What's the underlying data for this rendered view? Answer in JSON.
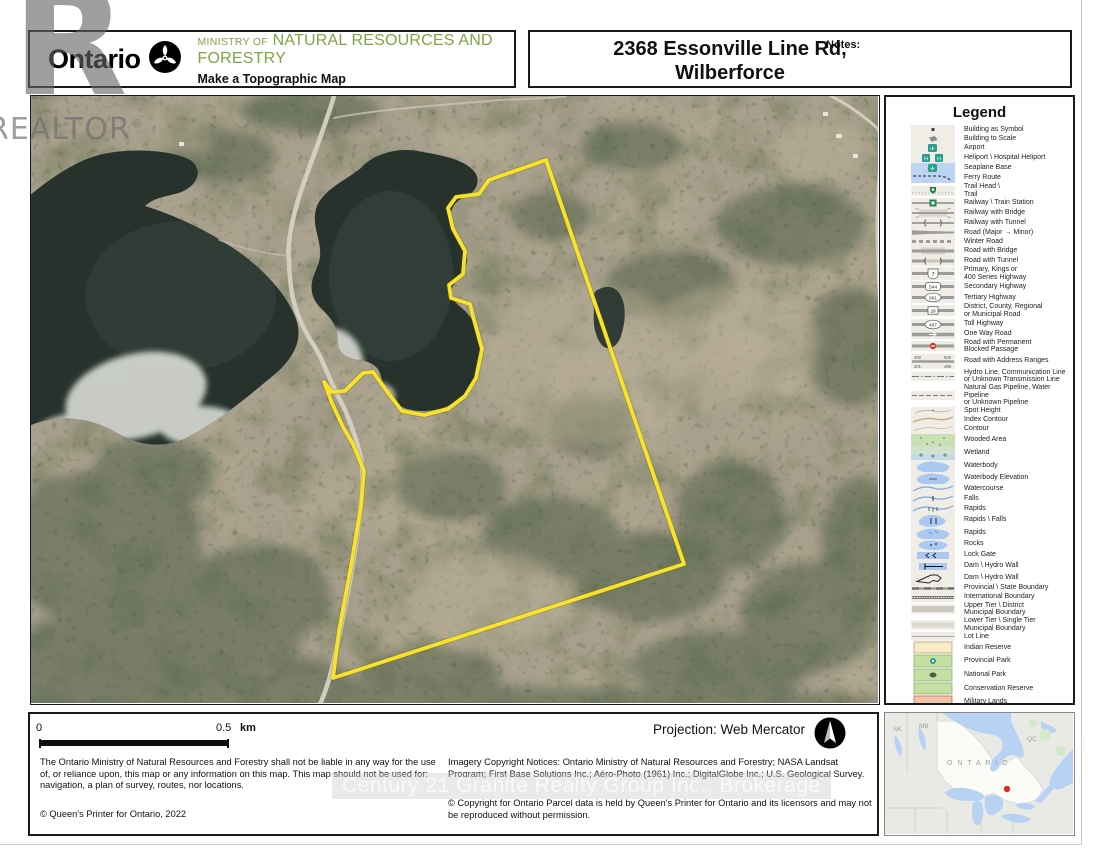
{
  "header": {
    "logo_text": "Ontario",
    "ministry_line_small": "MINISTRY OF",
    "ministry_line_big": "NATURAL RESOURCES AND FORESTRY",
    "app_title": "Make a Topographic Map",
    "map_title_line1": "2368 Essonville Line Rd,",
    "map_title_line2": "Wilberforce",
    "notes_label": "Notes:"
  },
  "watermarks": {
    "realtor_letter": "R",
    "realtor_word": "REALTOR",
    "realtor_reg": "®",
    "century21": "Century 21 Granite Realty Group Inc., Brokerage"
  },
  "legend": {
    "title": "Legend",
    "badges": {
      "primary": "7",
      "secondary": "544",
      "tertiary": "801",
      "municipal": "28",
      "toll": "407",
      "addr_tl": "400",
      "addr_tr": "500",
      "addr_bl": "401",
      "addr_br": "499"
    },
    "items": [
      {
        "sym": "building-symbol",
        "label": "Building as Symbol"
      },
      {
        "sym": "building-scale",
        "label": "Building to Scale"
      },
      {
        "sym": "airport",
        "label": "Airport"
      },
      {
        "sym": "heliport",
        "label": "Heliport \\ Hospital Heliport"
      },
      {
        "sym": "seaplane",
        "label": "Seaplane Base"
      },
      {
        "sym": "ferry",
        "label": "Ferry Route"
      },
      {
        "sym": "trail",
        "label": "Trail Head \\\nTrail"
      },
      {
        "sym": "railway-station",
        "label": "Railway \\ Train Station"
      },
      {
        "sym": "railway-bridge",
        "label": "Railway with Bridge"
      },
      {
        "sym": "railway-tunnel",
        "label": "Railway with Tunnel"
      },
      {
        "sym": "road-major-minor",
        "label": "Road (Major → Minor)"
      },
      {
        "sym": "winter-road",
        "label": "Winter Road"
      },
      {
        "sym": "road-bridge",
        "label": "Road with Bridge"
      },
      {
        "sym": "road-tunnel",
        "label": "Road with Tunnel"
      },
      {
        "sym": "primary-hwy",
        "label": "Primary, Kings or\n400 Series Highway"
      },
      {
        "sym": "secondary-hwy",
        "label": "Secondary Highway"
      },
      {
        "sym": "tertiary-hwy",
        "label": "Tertiary Highway"
      },
      {
        "sym": "municipal-road",
        "label": "District, County, Regional\nor Municipal Road"
      },
      {
        "sym": "toll-hwy",
        "label": "Toll Highway"
      },
      {
        "sym": "oneway",
        "label": "One Way Road"
      },
      {
        "sym": "blocked",
        "label": "Road with Permanent\nBlocked Passage"
      },
      {
        "sym": "address-ranges",
        "label": "Road with Address Ranges"
      },
      {
        "sym": "hydro-line",
        "label": "Hydro Line, Communication Line\nor Unknown Transmission Line"
      },
      {
        "sym": "pipeline",
        "label": "Natural Gas Pipeline, Water Pipeline\nor Unknown Pipeline"
      },
      {
        "sym": "spot-height",
        "label": "Spot Height"
      },
      {
        "sym": "index-contour",
        "label": "Index Contour"
      },
      {
        "sym": "contour",
        "label": "Contour"
      },
      {
        "sym": "wooded",
        "label": "Wooded Area"
      },
      {
        "sym": "wetland",
        "label": "Wetland"
      },
      {
        "sym": "waterbody",
        "label": "Waterbody"
      },
      {
        "sym": "waterbody-elev",
        "label": "Waterbody Elevation"
      },
      {
        "sym": "watercourse",
        "label": "Watercourse"
      },
      {
        "sym": "falls",
        "label": "Falls"
      },
      {
        "sym": "rapids-line",
        "label": "Rapids"
      },
      {
        "sym": "rapids-falls",
        "label": "Rapids \\ Falls"
      },
      {
        "sym": "rapids-poly",
        "label": "Rapids"
      },
      {
        "sym": "rocks",
        "label": "Rocks"
      },
      {
        "sym": "lock-gate",
        "label": "Lock Gate"
      },
      {
        "sym": "dam",
        "label": "Dam \\ Hydro Wall"
      },
      {
        "sym": "dam2",
        "label": "Dam \\ Hydro Wall"
      },
      {
        "sym": "prov-boundary",
        "label": "Provincial \\ State Boundary"
      },
      {
        "sym": "intl-boundary",
        "label": "International Boundary"
      },
      {
        "sym": "upper-tier",
        "label": "Upper Tier \\ District\nMunicipal Boundary"
      },
      {
        "sym": "lower-tier",
        "label": "Lower Tier \\ Single Tier\nMunicipal Boundary"
      },
      {
        "sym": "lot-line",
        "label": "Lot Line"
      },
      {
        "sym": "indian-reserve",
        "label": "Indian Reserve"
      },
      {
        "sym": "prov-park",
        "label": "Provincial Park"
      },
      {
        "sym": "natl-park",
        "label": "National Park"
      },
      {
        "sym": "conservation",
        "label": "Conservation Reserve"
      },
      {
        "sym": "military",
        "label": "Military Lands"
      }
    ]
  },
  "footer": {
    "scale_zero": "0",
    "scale_half": "0.5",
    "scale_unit": "km",
    "projection": "Projection: Web Mercator",
    "disclaimer": "The Ontario Ministry of Natural Resources and Forestry shall not be liable in any way for the use of, or reliance upon, this map or any information on this map.  This map should not be used for: navigation, a plan of survey, routes, nor locations.",
    "queens_printer": "© Queen's Printer for Ontario, 2022",
    "imagery_notice": "Imagery Copyright Notices: Ontario Ministry of Natural Resources and Forestry; NASA Landsat Program; First Base Solutions Inc.; Aéro-Photo (1961) Inc.; DigitalGlobe Inc.; U.S. Geological Survey.",
    "parcel_notice": "© Copyright for Ontario Parcel data is held by Queen's Printer for Ontario and its licensors and may not be reproduced without permission."
  },
  "inset": {
    "label_sk": "SK",
    "label_mb": "MB",
    "label_ontario": "O N T A R I O",
    "label_qc": "QC",
    "marker_color": "#d93025"
  },
  "colors": {
    "boundary_yellow": "#f7e32b",
    "ministry_green": "#81a443",
    "water_blue": "#aac8f0",
    "lake_dark": "#27322d",
    "terrain_tan": "#a8a08c"
  }
}
